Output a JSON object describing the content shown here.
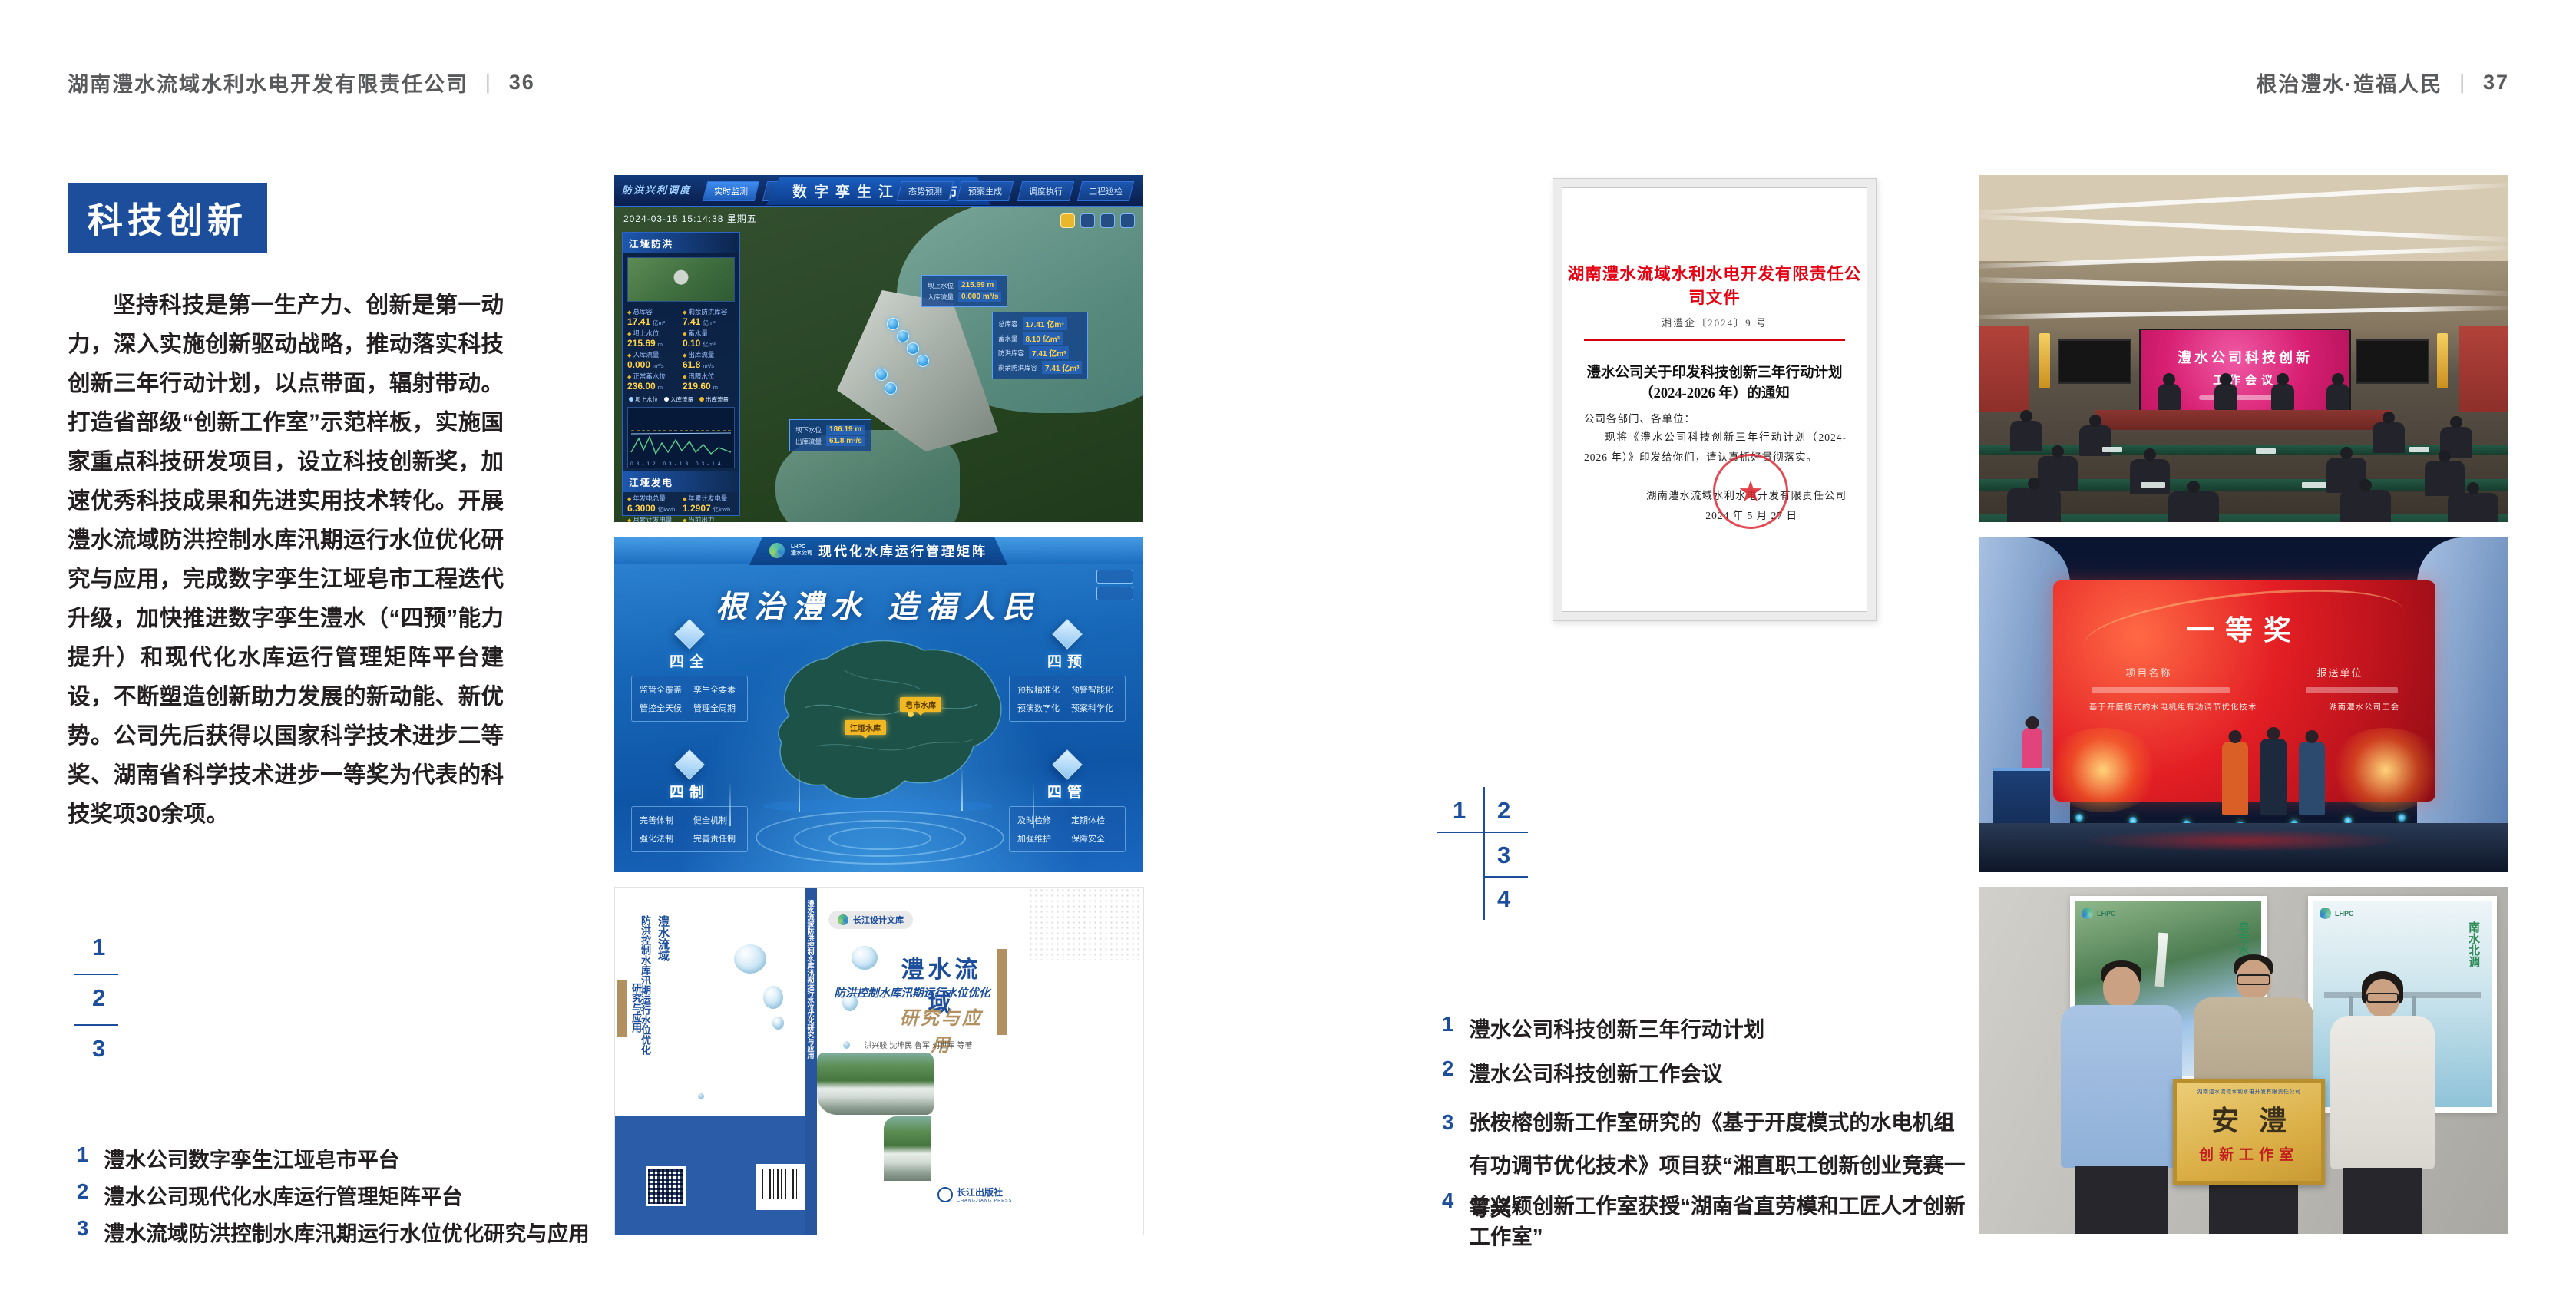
{
  "left": {
    "header": {
      "title": "湖南澧水流域水利水电开发有限责任公司",
      "divider": "|",
      "page_no": "36"
    },
    "badge": "科技创新",
    "body": "坚持科技是第一生产力、创新是第一动力，深入实施创新驱动战略，推动落实科技创新三年行动计划，以点带面，辐射带动。打造省部级“创新工作室”示范样板，实施国家重点科技研发项目，设立科技创新奖，加速优秀科技成果和先进实用技术转化。开展澧水流域防洪控制水库汛期运行水位优化研究与应用，完成数字孪生江垭皂市工程迭代升级，加快推进数字孪生澧水（“四预”能力提升）和现代化水库运行管理矩阵平台建设，不断塑造创新助力发展的新动能、新优势。公司先后获得以国家科学技术进步二等奖、湖南省科学技术进步一等奖为代表的科技奖项30余项。",
    "fig_nums": [
      "1",
      "2",
      "3"
    ],
    "captions": [
      {
        "n": "1",
        "t": "澧水公司数字孪生江垭皂市平台"
      },
      {
        "n": "2",
        "t": "澧水公司现代化水库运行管理矩阵平台"
      },
      {
        "n": "3",
        "t": "澧水流域防洪控制水库汛期运行水位优化研究与应用"
      }
    ]
  },
  "right": {
    "header": {
      "title": "根治澧水·造福人民",
      "divider": "|",
      "page_no": "37"
    },
    "fig_nums": [
      "1",
      "2",
      "3",
      "4"
    ],
    "captions": [
      {
        "n": "1",
        "t": "澧水公司科技创新三年行动计划"
      },
      {
        "n": "2",
        "t": "澧水公司科技创新工作会议"
      },
      {
        "n": "3",
        "t": "张桉榕创新工作室研究的《基于开度模式的水电机组有功调节优化技术》项目获“湘直职工创新创业竞赛一等奖”"
      },
      {
        "n": "4",
        "t": "曾兴颖创新工作室获授“湖南省直劳模和工匠人才创新工作室”"
      }
    ]
  },
  "dash": {
    "corner": "防洪兴利调度",
    "title": "数字孪生江垭皂市",
    "datetime": "2024-03-15 15:14:38 星期五",
    "tabs_left": [
      "实时监测",
      "洪水预报",
      "防汛预警"
    ],
    "tabs_right": [
      "态势预测",
      "预案生成",
      "调度执行",
      "工程巡检"
    ],
    "panel1": "江垭防洪",
    "panel2": "江垭发电",
    "p1": [
      {
        "l": "总库容",
        "v": "17.41",
        "u": "亿m³"
      },
      {
        "l": "剩余防洪库容",
        "v": "7.41",
        "u": "亿m³"
      },
      {
        "l": "坝上水位",
        "v": "215.69",
        "u": "m"
      },
      {
        "l": "蓄水量",
        "v": "0.10",
        "u": "亿m³"
      },
      {
        "l": "入库流量",
        "v": "0.000",
        "u": "m³/s"
      },
      {
        "l": "出库流量",
        "v": "61.8",
        "u": "m³/s"
      },
      {
        "l": "正常蓄水位",
        "v": "236.00",
        "u": "m"
      },
      {
        "l": "汛限水位",
        "v": "219.60",
        "u": "m"
      }
    ],
    "legend": [
      "坝上水位",
      "入库流量",
      "出库流量"
    ],
    "xticks": [
      "03-12",
      "03-13",
      "03-14"
    ],
    "p2": [
      {
        "l": "年发电总量",
        "v": "6.3000",
        "u": "亿kWh"
      },
      {
        "l": "年累计发电量",
        "v": "1.2907",
        "u": "亿kWh"
      },
      {
        "l": "月累计发电量",
        "v": "3359.21",
        "u": "万kWh"
      },
      {
        "l": "当前出力",
        "v": "0.00",
        "u": "MW"
      },
      {
        "l": "发电流量",
        "v": "0.00",
        "u": "m³/s"
      },
      {
        "l": "弃水流量",
        "v": "0.00",
        "u": "m³/s"
      }
    ],
    "gauges": [
      "0.00",
      "102.98",
      "0.00"
    ],
    "co1": [
      {
        "l": "坝上水位",
        "v": "215.69 m"
      },
      {
        "l": "入库流量",
        "v": "0.000 m³/s"
      }
    ],
    "co2": [
      {
        "l": "总库容",
        "v": "17.41 亿m³"
      },
      {
        "l": "蓄水量",
        "v": "8.10 亿m³"
      },
      {
        "l": "防洪库容",
        "v": "7.41 亿m³"
      },
      {
        "l": "剩余防洪库容",
        "v": "7.41 亿m³"
      }
    ],
    "co3": [
      {
        "l": "坝下水位",
        "v": "186.19 m"
      },
      {
        "l": "出库流量",
        "v": "61.8 m³/s"
      }
    ]
  },
  "plat": {
    "logo_abbr": "LHPC",
    "logo_name": "澧水公司",
    "title": "现代化水库运行管理矩阵",
    "slogan": "根治澧水 造福人民",
    "groups": [
      {
        "name": "四全",
        "items": [
          "监管全覆盖",
          "孪生全要素",
          "管控全天候",
          "管理全周期"
        ]
      },
      {
        "name": "四制",
        "items": [
          "完善体制",
          "健全机制",
          "强化法制",
          "完善责任制"
        ]
      },
      {
        "name": "四预",
        "items": [
          "预报精准化",
          "预警智能化",
          "预演数字化",
          "预案科学化"
        ]
      },
      {
        "name": "四管",
        "items": [
          "及时检修",
          "定期体检",
          "加强维护",
          "保障安全"
        ]
      }
    ],
    "label1": "皂市水库",
    "label2": "江垭水库"
  },
  "book": {
    "series": "长江设计文库",
    "title": "澧水流域",
    "subtitle": "防洪控制水库汛期运行水位优化",
    "subtitle2": "研究与应用",
    "authors": "洪兴骏  沈坤民  鲁军  刘世军  等著",
    "publisher": "长江出版社",
    "publisher_en": "CHANGJIANG PRESS",
    "spine": "澧水流域防洪控制水库汛期运行水位优化研究与应用",
    "back_title1": "澧水流域",
    "back_title2": "防洪控制水库汛期运行水位优化",
    "back_sub": "研究与应用"
  },
  "doc": {
    "letterhead": "湖南澧水流域水利水电开发有限责任公司文件",
    "number": "湘澧企〔2024〕9 号",
    "title1": "澧水公司关于印发科技创新三年行动计划",
    "title2": "（2024-2026 年）的通知",
    "salute": "公司各部门、各单位：",
    "body": "现将《澧水公司科技创新三年行动计划（2024-2026 年）》印发给你们，请认真抓好贯彻落实。",
    "sign": "湖南澧水流域水利水电开发有限责任公司",
    "date": "2024 年 5 月 27 日",
    "seal_star": "★"
  },
  "meeting": {
    "line1": "澧水公司科技创新",
    "line2": "工作会议"
  },
  "award": {
    "title": "一等奖",
    "col1": "项目名称",
    "col2": "报送单位",
    "row2a": "基于开度模式的水电机组有功调节优化技术",
    "row2b": "湖南澧水公司工会"
  },
  "plaque": {
    "org": "湖南澧水流域水利水电开发有限责任公司",
    "name": "安澧",
    "sub": "创新工作室",
    "poster_left": "皂市水库",
    "poster_right": "南水北调"
  }
}
